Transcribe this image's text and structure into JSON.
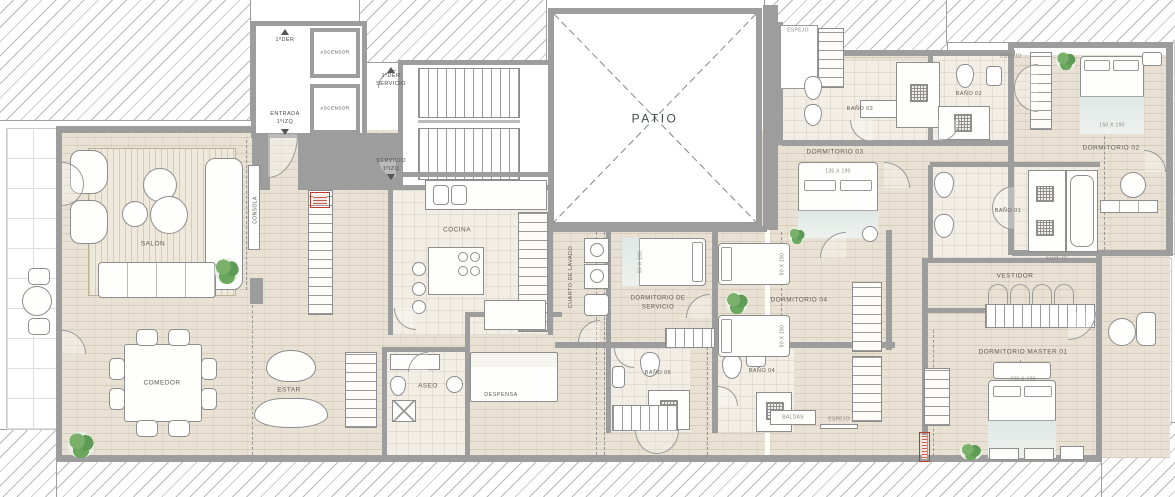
{
  "document": {
    "type": "architectural floor plan",
    "unit": "1ºIZQ"
  },
  "colors": {
    "wall": "#9d9d9d",
    "floor_brick": "#e9e2d4",
    "floor_tile": "#f2eee5",
    "annotation_red": "#c0392b",
    "plant_green": "#5d9b57"
  },
  "labels": {
    "salon": "SALÓN",
    "comedor": "COMEDOR",
    "estar": "ESTAR",
    "consola": "CONSOLA",
    "aseo": "ASEO",
    "despensa": "DESPENSA",
    "cocina": "COCINA",
    "cuarto_lavado": "CUARTO DE LAVADO",
    "dormitorio_servicio": "DORMITORIO DE\nSERVICIO",
    "dormitorio_04": "DORMITORIO 04",
    "bano_05": "BAÑO 05",
    "bano_04": "BAÑO 04",
    "patio": "PATIO",
    "dormitorio_03": "DORMITORIO 03",
    "bano_03": "BAÑO 03",
    "bano_02": "BAÑO 02",
    "bano_01": "BAÑO 01",
    "dormitorio_02": "DORMITORIO 02",
    "vestidor": "VESTIDOR",
    "dormitorio_master": "DORMITORIO MASTER 01",
    "ascensor_1": "ASCENSOR",
    "ascensor_2": "ASCENSOR",
    "entrada": "ENTRADA\n1ºIZQ",
    "puerta_1der": "1ºDER",
    "servicio_1der": "1ºDER\nSERVICIO",
    "servicio_1izq": "SERVICIO\n1ºIZQ",
    "espejo_1": "ESPEJO",
    "espejo_2": "ESPEJO",
    "espejo_3": "ESPEJO",
    "espejo_4": "ESPEJO",
    "baldas": "BALDAS",
    "cama_dormitorio_03": "135 X 190",
    "cama_dormitorio_02": "150 X 190",
    "cama_master": "200 X 180",
    "cama_servicio": "90 X 190",
    "cama_d04_a": "90 X 190",
    "cama_d04_b": "90 X 190"
  }
}
